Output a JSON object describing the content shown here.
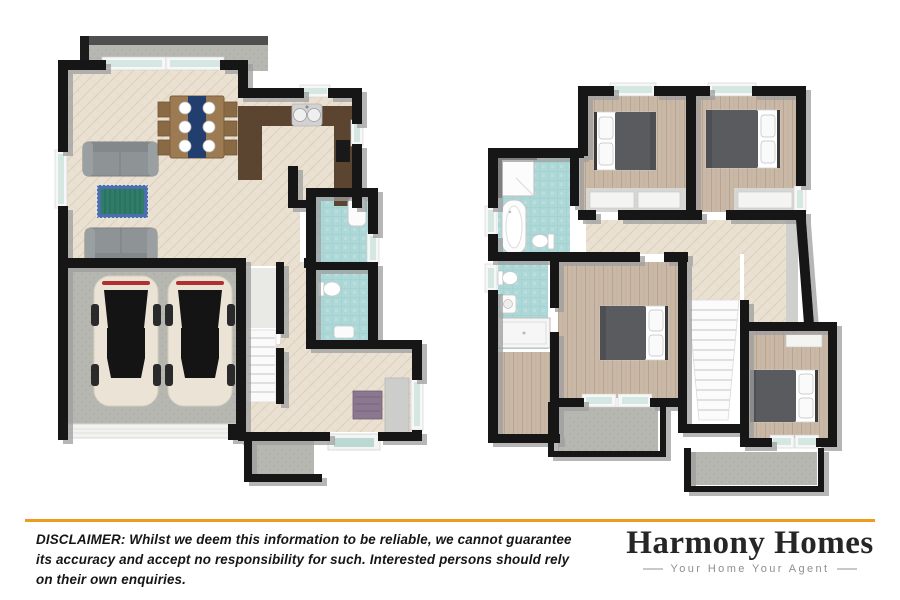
{
  "footer": {
    "divider_color": "#EE9C1D",
    "disclaimer_lines": [
      "DISCLAIMER: Whilst we deem this information to be reliable, we cannot guarantee",
      "its accuracy and accept no responsibility for such. Interested persons should rely",
      "on their own enquiries."
    ],
    "brand": {
      "name": "Harmony Homes",
      "tagline": "Your Home Your Agent"
    }
  },
  "plans": {
    "ground_floor": {
      "position": "left",
      "rooms": [
        "deck",
        "living-room",
        "dining-area",
        "kitchen",
        "laundry",
        "wc",
        "stairs",
        "hallway",
        "entry",
        "porch",
        "double-garage"
      ],
      "furniture": [
        "sofa",
        "sofa",
        "area-rug",
        "dining-table-6-chairs",
        "kitchen-sink",
        "cooktop",
        "laundry-tub",
        "toilet",
        "console-table",
        "storage-cabinet",
        "car",
        "car"
      ]
    },
    "upper_floor": {
      "position": "right",
      "rooms": [
        "bathroom",
        "bedroom-2",
        "bedroom-3",
        "ensuite",
        "hallway",
        "master-bedroom",
        "walk-in-robe",
        "stairs",
        "bedroom-4",
        "balcony",
        "deck"
      ],
      "furniture": [
        "corner-shower",
        "bathtub",
        "toilet",
        "toilet",
        "vanity-sink",
        "shower",
        "double-bed",
        "double-bed",
        "double-bed",
        "double-bed",
        "wardrobe-shelves"
      ]
    }
  },
  "colors": {
    "accent_orange": "#EE9C1D",
    "wall_black": "#161616",
    "wall_shadow_grey": "#9E9E9E",
    "floor_cream": "#EAE1D2",
    "floor_wood": "#C9B8A6",
    "tile_teal": "#AED8D7",
    "concrete_grey": "#B7B7B2",
    "sofa_grey": "#8E9396",
    "rug_green": "#2F7C68",
    "rug_blue": "#4A6FAE",
    "counter_brown": "#5C4530",
    "table_wood": "#9D7B52",
    "runner_navy": "#223E6F",
    "bed_duvet_grey": "#5A5B5E",
    "car_cream": "#EBE4D6",
    "console_purple": "#8B7790",
    "brand_text": "#262626",
    "tagline_grey": "#8F8F8F"
  }
}
